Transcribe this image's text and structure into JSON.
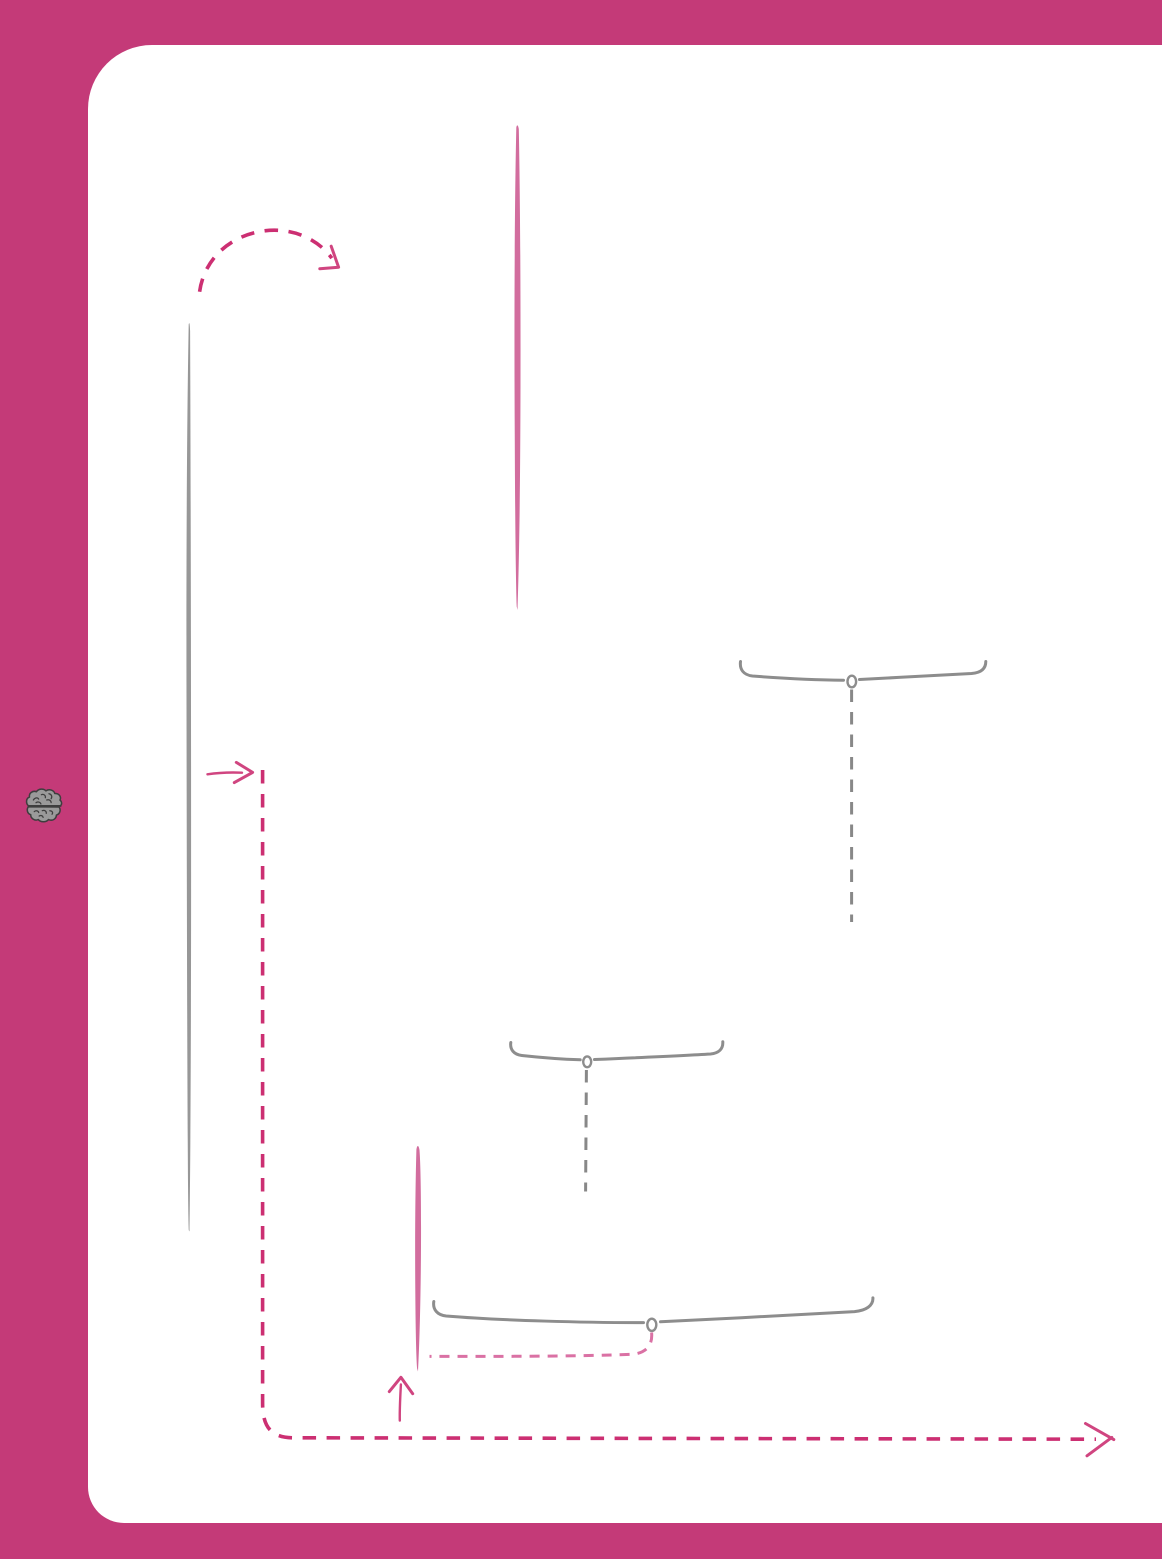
{
  "page": {
    "kind": "blank workbook page with hand-drawn annotation marks",
    "width": 1162,
    "height": 1559,
    "visible_text": ""
  },
  "colors": {
    "background": "#c43a78",
    "card": "#ffffff",
    "accent_dashed_pink": "#cc2f72",
    "arrow_pink": "#d04580",
    "marker_pink": "#d26d9e",
    "light_dashed_pink": "#da71a4",
    "brace_gray": "#8d8d8d",
    "dashed_gray": "#888888",
    "marker_gray": "#979797",
    "brain_fill": "#9a9a9a",
    "brain_outline": "#3e3e3e"
  },
  "icons": {
    "brain": {
      "name": "brain-icon",
      "style": "hand-drawn gray brain on pink sidebar"
    }
  },
  "annotations": [
    {
      "name": "curved-dashed-arrow",
      "type": "arrow",
      "stroke": "dashed",
      "direction": "arcs up and to the right",
      "color_ref": "accent_dashed_pink"
    },
    {
      "name": "pink-marker-line-top",
      "type": "highlighter-stroke",
      "orientation": "vertical",
      "color_ref": "marker_pink"
    },
    {
      "name": "gray-marker-line",
      "type": "highlighter-stroke",
      "orientation": "vertical",
      "color_ref": "marker_gray"
    },
    {
      "name": "right-arrow",
      "type": "arrow",
      "stroke": "solid",
      "direction": "right",
      "color_ref": "arrow_pink"
    },
    {
      "name": "pink-dashed-route",
      "type": "connector",
      "stroke": "dashed",
      "path": "down the left side, rounded corner, right along the bottom, arrowhead at right end",
      "color_ref": "accent_dashed_pink"
    },
    {
      "name": "top-brace",
      "type": "curly-brace",
      "orientation": "horizontal, pointer loop at center bottom",
      "color_ref": "brace_gray"
    },
    {
      "name": "top-brace-dashed-leader",
      "type": "leader-line",
      "stroke": "dashed",
      "orientation": "vertical",
      "color_ref": "dashed_gray"
    },
    {
      "name": "middle-brace",
      "type": "curly-brace",
      "orientation": "horizontal, pointer loop at center bottom",
      "color_ref": "brace_gray"
    },
    {
      "name": "middle-brace-dashed-leader",
      "type": "leader-line",
      "stroke": "dashed",
      "orientation": "vertical",
      "color_ref": "dashed_gray"
    },
    {
      "name": "pink-marker-line-bottom",
      "type": "highlighter-stroke",
      "orientation": "vertical",
      "color_ref": "marker_pink"
    },
    {
      "name": "bottom-brace",
      "type": "curly-brace",
      "orientation": "horizontal, pointer loop at center bottom",
      "color_ref": "brace_gray"
    },
    {
      "name": "bottom-brace-dashed-leader",
      "type": "leader-line",
      "stroke": "dashed",
      "path": "curves down-left from brace loop to the pink marker line",
      "color_ref": "light_dashed_pink"
    },
    {
      "name": "up-arrow",
      "type": "arrow",
      "stroke": "solid",
      "direction": "up",
      "color_ref": "arrow_pink"
    }
  ]
}
